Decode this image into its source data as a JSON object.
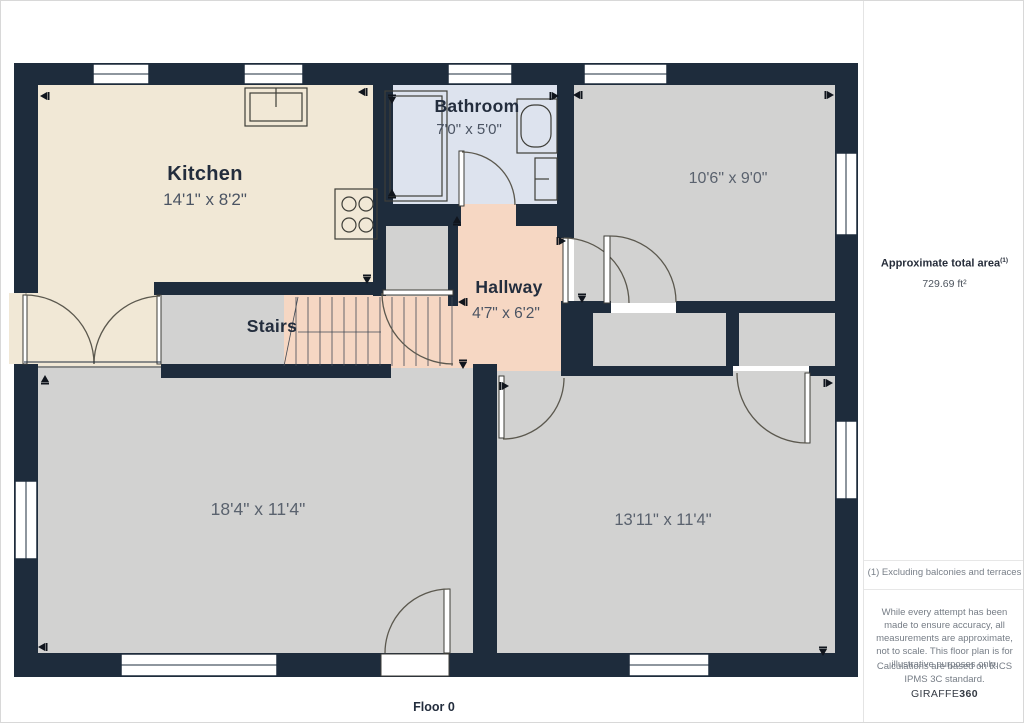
{
  "plan": {
    "floor_label": "Floor 0",
    "rooms": {
      "kitchen": {
        "name": "Kitchen",
        "dims": "14'1\" x 8'2\""
      },
      "bathroom": {
        "name": "Bathroom",
        "dims": "7'0\" x 5'0\""
      },
      "hallway": {
        "name": "Hallway",
        "dims": "4'7\" x 6'2\""
      },
      "stairs": {
        "name": "Stairs"
      },
      "room_top_right": {
        "dims": "10'6\" x 9'0\""
      },
      "room_bottom_left": {
        "dims": "18'4\" x 11'4\""
      },
      "room_bottom_right": {
        "dims": "13'11\" x 11'4\""
      }
    },
    "colors": {
      "wall": "#1e2c3c",
      "kitchen_floor": "#f1e8d6",
      "bathroom_floor": "#dde3ee",
      "hallway_floor": "#f6d7c3",
      "room_floor": "#d2d2d1"
    }
  },
  "sidebar": {
    "area_title": "Approximate total area",
    "area_footnote_ref": "(1)",
    "area_value": "729.69 ft²",
    "footnote": "(1) Excluding balconies and terraces",
    "disclaimer": "While every attempt has been made to ensure accuracy, all measurements are approximate, not to scale. This floor plan is for illustrative purposes only.",
    "standard_note": "Calculations are based on RICS IPMS 3C standard.",
    "brand_prefix": "GIRAFFE",
    "brand_suffix": "360"
  }
}
